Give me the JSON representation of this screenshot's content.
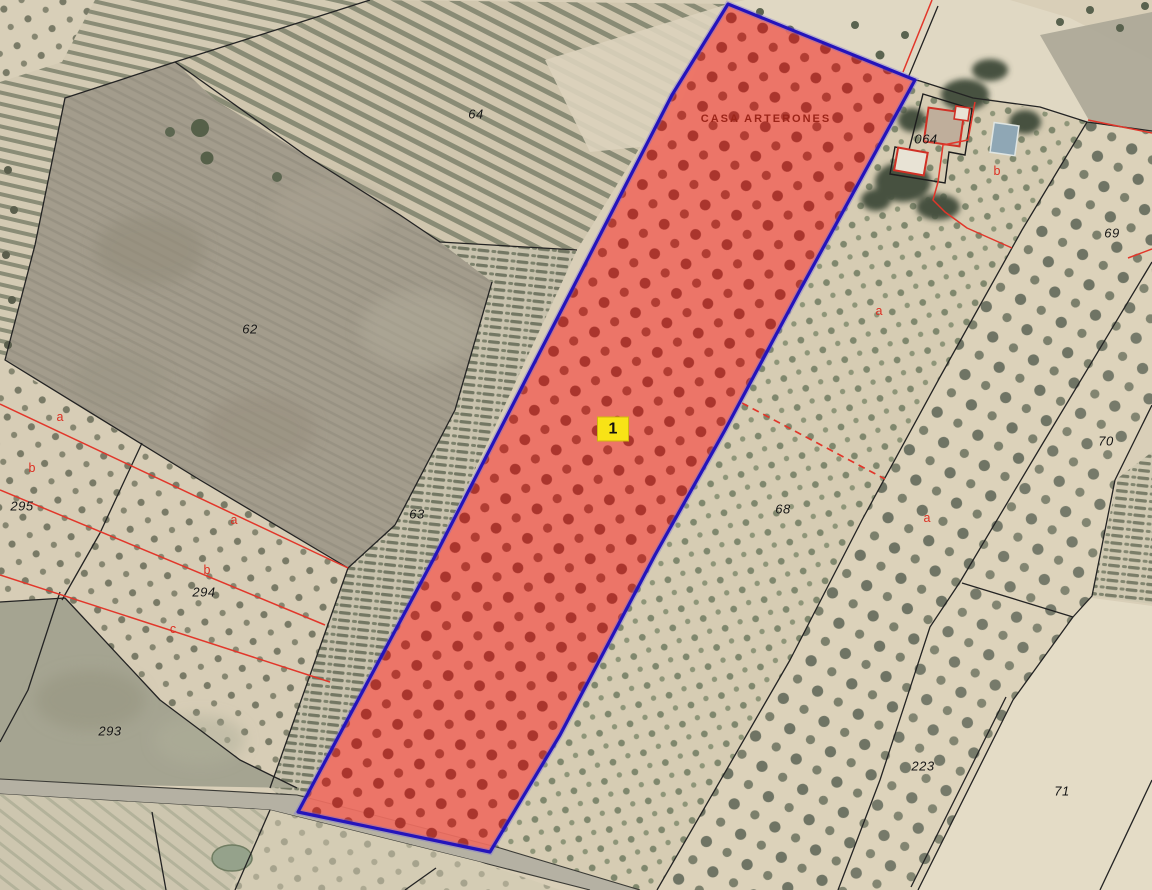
{
  "app": {
    "type": "cadastral-aerial-parcel-viewer"
  },
  "colors": {
    "highlight_fill": "#ee6e61",
    "highlight_dots": "#a63129",
    "highlight_border": "#2414bb",
    "boundary_black": "#232323",
    "boundary_red": "#e2362a",
    "badge_yellow": "#f8e316",
    "ground_beige": "#d9cfb8",
    "bare_field_grey": "#a39c8c"
  },
  "selected_parcel": {
    "number": "1",
    "name": "CASA ARTERONES",
    "name_label_pos": {
      "x": 766,
      "y": 119
    },
    "number_badge_pos": {
      "x": 613,
      "y": 429
    }
  },
  "parcel_labels": [
    {
      "text": "64",
      "x": 476,
      "y": 114
    },
    {
      "text": "62",
      "x": 250,
      "y": 329
    },
    {
      "text": "63",
      "x": 417,
      "y": 514
    },
    {
      "text": "68",
      "x": 783,
      "y": 509
    },
    {
      "text": "69",
      "x": 1112,
      "y": 233
    },
    {
      "text": "70",
      "x": 1106,
      "y": 441
    },
    {
      "text": "71",
      "x": 1062,
      "y": 791
    },
    {
      "text": "223",
      "x": 923,
      "y": 766
    },
    {
      "text": "293",
      "x": 110,
      "y": 731
    },
    {
      "text": "294",
      "x": 204,
      "y": 592
    },
    {
      "text": "295",
      "x": 22,
      "y": 506
    },
    {
      "text": "064",
      "x": 926,
      "y": 139
    }
  ],
  "subparcel_labels": [
    {
      "text": "a",
      "x": 60,
      "y": 417
    },
    {
      "text": "b",
      "x": 32,
      "y": 468
    },
    {
      "text": "a",
      "x": 234,
      "y": 520
    },
    {
      "text": "b",
      "x": 207,
      "y": 570
    },
    {
      "text": "c",
      "x": 173,
      "y": 629
    },
    {
      "text": "b",
      "x": 997,
      "y": 171
    },
    {
      "text": "a",
      "x": 879,
      "y": 311
    },
    {
      "text": "a",
      "x": 927,
      "y": 518
    }
  ]
}
